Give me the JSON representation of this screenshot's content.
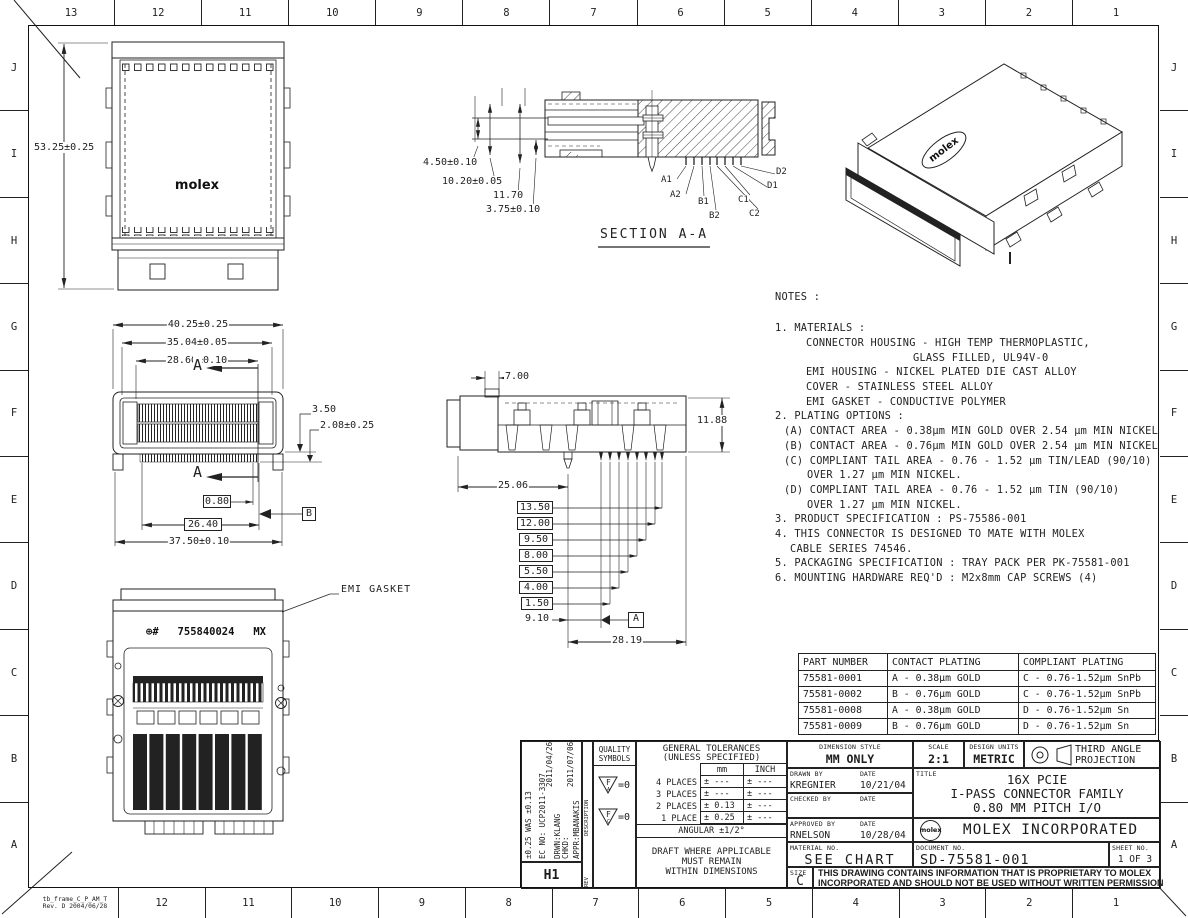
{
  "frame": {
    "file_ref_line1": "tb_frame_C_P_AM_T",
    "file_ref_line2": "Rev. D 2004/06/28",
    "zone_columns": [
      "13",
      "12",
      "11",
      "10",
      "9",
      "8",
      "7",
      "6",
      "5",
      "4",
      "3",
      "2",
      "1"
    ],
    "zone_rows": [
      "J",
      "I",
      "H",
      "G",
      "F",
      "E",
      "D",
      "C",
      "B",
      "A"
    ]
  },
  "views": {
    "top_view": {
      "logo": "molex",
      "height_dim": "53.25±0.25"
    },
    "front_view": {
      "dims": {
        "w1": "40.25±0.25",
        "w2": "35.04±0.05",
        "w3": "28.60±0.10",
        "h1": "3.50",
        "h2": "2.08±0.25",
        "pitch": "0.80",
        "span": "26.40",
        "w4": "37.50±0.10"
      },
      "section_mark": "A",
      "datum_b": "B"
    },
    "section_view": {
      "title": "SECTION A-A",
      "d1": "4.50±0.10",
      "d2": "10.20±0.05",
      "d3": "11.70",
      "d4": "3.75±0.10",
      "pins": [
        "A1",
        "A2",
        "B1",
        "B2",
        "C1",
        "C2",
        "D1",
        "D2"
      ]
    },
    "side_view": {
      "d_top": "7.00",
      "d_height": "11.88",
      "d_left": "25.06",
      "boxed": [
        "13.50",
        "12.00",
        "9.50",
        "8.00",
        "5.50",
        "4.00",
        "1.50"
      ],
      "d_tail": "9.10",
      "d_span": "28.19",
      "datum_a": "A"
    },
    "emi_view": {
      "callout": "EMI GASKET",
      "marking_prefix": "⊕#",
      "marking_number": "755840024",
      "marking_suffix": "MX"
    },
    "iso_view": {
      "logo": "molex"
    }
  },
  "notes": {
    "title": "NOTES :",
    "lines": [
      "1.  MATERIALS :",
      "CONNECTOR HOUSING - HIGH TEMP THERMOPLASTIC,",
      "GLASS FILLED, UL94V-0",
      "EMI HOUSING - NICKEL PLATED DIE CAST ALLOY",
      "COVER - STAINLESS STEEL ALLOY",
      "EMI GASKET - CONDUCTIVE POLYMER",
      "2.  PLATING OPTIONS :",
      "(A) CONTACT AREA - 0.38µm MIN GOLD OVER 2.54 µm MIN NICKEL",
      "(B) CONTACT AREA - 0.76µm MIN GOLD OVER 2.54 µm MIN NICKEL",
      "(C) COMPLIANT TAIL AREA - 0.76 - 1.52 µm TIN/LEAD (90/10)",
      "OVER 1.27 µm MIN NICKEL.",
      "(D) COMPLIANT TAIL AREA - 0.76 - 1.52 µm TIN (90/10)",
      "OVER 1.27 µm MIN NICKEL.",
      "3.  PRODUCT SPECIFICATION : PS-75586-001",
      "4.  THIS CONNECTOR IS DESIGNED TO MATE WITH MOLEX",
      "CABLE SERIES 74546.",
      "5.  PACKAGING SPECIFICATION : TRAY PACK PER PK-75581-001",
      "6.  MOUNTING HARDWARE REQ'D : M2x8mm CAP SCREWS (4)"
    ]
  },
  "part_table": {
    "headers": [
      "PART NUMBER",
      "CONTACT PLATING",
      "COMPLIANT PLATING"
    ],
    "rows": [
      [
        "75581-0001",
        "A - 0.38µm GOLD",
        "C - 0.76-1.52µm SnPb"
      ],
      [
        "75581-0002",
        "B - 0.76µm GOLD",
        "C - 0.76-1.52µm SnPb"
      ],
      [
        "75581-0008",
        "A - 0.38µm GOLD",
        "D - 0.76-1.52µm Sn"
      ],
      [
        "75581-0009",
        "B - 0.76µm GOLD",
        "D - 0.76-1.52µm Sn"
      ]
    ]
  },
  "title_block": {
    "revision": {
      "change": "±0.25 WAS ±0.13",
      "ec_no": "EC NO: UCP2011-3307",
      "date1": "2011/04/26",
      "drwn": "DRWN:KLANG",
      "date2": "2011/07/06",
      "chkd": "CHKD:",
      "appr": "APPR:MBANAKIS",
      "description_label": "DESCRIPTION",
      "rev_label": "REV",
      "rev_code": "H1"
    },
    "quality": {
      "title1": "QUALITY",
      "title2": "SYMBOLS",
      "sym1": "F",
      "sym1_sub": "A",
      "sym2": "F",
      "sym2_sub": "C",
      "eq1": "=0",
      "eq2": "=0"
    },
    "tolerances": {
      "title1": "GENERAL TOLERANCES",
      "title2": "(UNLESS SPECIFIED)",
      "col_mm": "mm",
      "col_inch": "INCH",
      "rows": [
        {
          "label": "4 PLACES",
          "mm": "± ---",
          "inch": "± ---"
        },
        {
          "label": "3 PLACES",
          "mm": "± ---",
          "inch": "± ---"
        },
        {
          "label": "2 PLACES",
          "mm": "± 0.13",
          "inch": "± ---"
        },
        {
          "label": "1 PLACE",
          "mm": "± 0.25",
          "inch": "± ---"
        }
      ],
      "angular": "ANGULAR ±1/2°",
      "draft1": "DRAFT WHERE APPLICABLE",
      "draft2": "MUST REMAIN",
      "draft3": "WITHIN DIMENSIONS"
    },
    "info": {
      "dimension_style_label": "DIMENSION STYLE",
      "dimension_style": "MM ONLY",
      "scale_label": "SCALE",
      "scale": "2:1",
      "design_units_label": "DESIGN UNITS",
      "design_units": "METRIC",
      "projection_line1": "THIRD ANGLE",
      "projection_line2": "PROJECTION",
      "drawn_by_label": "DRAWN BY",
      "drawn_by": "KREGNIER",
      "date_label1": "DATE",
      "drawn_date": "10/21/04",
      "checked_by_label": "CHECKED BY",
      "date_label2": "DATE",
      "approved_by_label": "APPROVED BY",
      "approved_by": "RNELSON",
      "date_label3": "DATE",
      "approved_date": "10/28/04",
      "title_label": "TITLE",
      "title_line1": "16X PCIE",
      "title_line2": "I-PASS CONNECTOR FAMILY",
      "title_line3": "0.80 MM PITCH I/O",
      "logo": "molex",
      "company": "MOLEX INCORPORATED",
      "material_label": "MATERIAL NO.",
      "material": "SEE CHART",
      "document_label": "DOCUMENT NO.",
      "document": "SD-75581-001",
      "sheet_label": "SHEET NO.",
      "sheet": "1 OF 3",
      "size_label": "SIZE",
      "size": "C",
      "proprietary1": "THIS DRAWING CONTAINS INFORMATION THAT IS PROPRIETARY TO MOLEX",
      "proprietary2": "INCORPORATED AND SHOULD NOT BE USED WITHOUT WRITTEN PERMISSION"
    }
  }
}
